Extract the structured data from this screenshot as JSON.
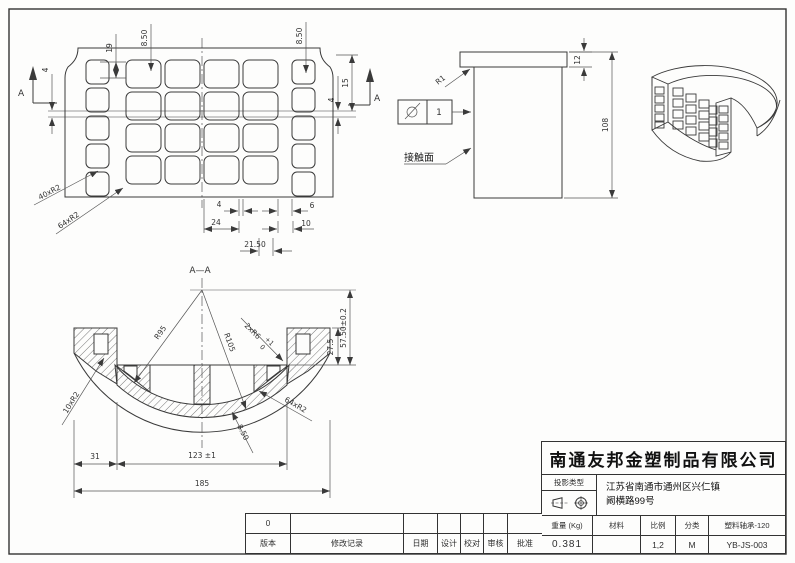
{
  "plan_view": {
    "section_arrow_label_left": "A",
    "section_arrow_label_right": "A",
    "dim_19": "19",
    "dim_850_left": "8.50",
    "dim_850_right": "8.50",
    "dim_4_left": "4",
    "dim_15": "15",
    "dim_4_right": "4",
    "dim_4_bottom": "4",
    "dim_24": "24",
    "dim_6": "6",
    "dim_10": "10",
    "dim_2150": "21.50",
    "leader_40xR2": "40xR2",
    "leader_64xR2": "64xR2"
  },
  "side_view": {
    "dim_12": "12",
    "dim_108": "108",
    "radius_r1": "R1",
    "finish_value": "1",
    "contact_surface_label": "接触面"
  },
  "section_view": {
    "title": "A—A",
    "radius_r95": "R95",
    "radius_r105": "R105",
    "leader_2xR6": "2xR6",
    "tol_upper": "+1",
    "tol_lower": "0",
    "leader_10xR2": "10xR2",
    "leader_64xR2": "64xR2",
    "leader_850": "8.50",
    "dim_275": "27.5",
    "dim_5750": "57.50±0.2",
    "dim_31": "31",
    "dim_123": "123 ±1",
    "dim_185": "185"
  },
  "title_block": {
    "company": "南通友邦金塑制品有限公司",
    "projection_label": "投影类型",
    "address_line1": "江苏省南通市通州区兴仁镇",
    "address_line2": "阚横路99号",
    "col_weight": "重量 (Kg)",
    "col_material": "材料",
    "col_scale": "比例",
    "col_category": "分类",
    "part_name": "塑料轴承-120",
    "weight_value": "0.381",
    "material_value": "",
    "scale_value": "1,2",
    "category_value": "M",
    "drawing_number": "YB-JS-003"
  },
  "revision_table": {
    "rev_value": "0",
    "col_version": "版本",
    "col_record": "修改记录",
    "col_date": "日期",
    "col_design": "设计",
    "col_check": "校对",
    "col_review": "审核",
    "col_approve": "批准"
  }
}
